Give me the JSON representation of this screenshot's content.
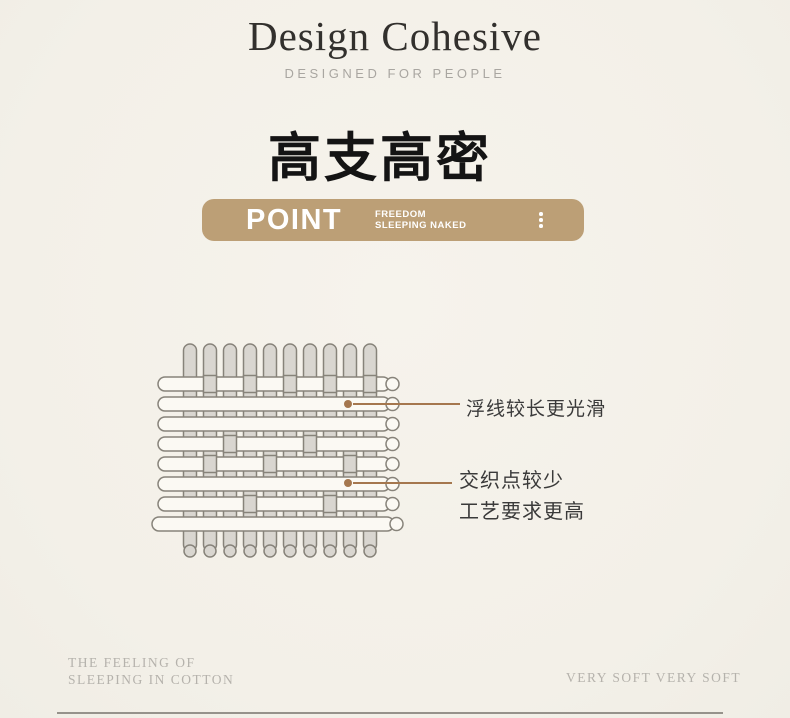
{
  "header": {
    "brand": "Design Cohesive",
    "tagline": "DESIGNED FOR PEOPLE"
  },
  "section_title": "高支高密",
  "banner": {
    "label": "POINT",
    "sub_line1": "FREEDOM",
    "sub_line2": "SLEEPING NAKED",
    "bg_color": "#bc9f76",
    "text_color": "#ffffff",
    "menu_icon": "vertical-ellipsis-icon"
  },
  "diagram": {
    "type": "weave-illustration",
    "description": "woven fabric diagram: vertical warp threads interlaced with long horizontal weft floats",
    "warp_count": 10,
    "weft_count": 8,
    "warp_fill": "#d9d6d0",
    "weft_fill": "#fbf9f3",
    "outline_color": "#87837a",
    "crossings": {
      "0": [
        1,
        3,
        5,
        7,
        9
      ],
      "3": [
        2,
        6
      ],
      "4": [
        1,
        4,
        8
      ],
      "6": [
        3,
        7
      ]
    },
    "annotation_color": "#a5774e",
    "annotations": [
      {
        "text": "浮线较长更光滑"
      },
      {
        "text_line1": "交织点较少",
        "text_line2": "工艺要求更高"
      }
    ]
  },
  "footer": {
    "left_line1": "THE FEELING OF",
    "left_line2": "SLEEPING IN COTTON",
    "right": "VERY SOFT VERY SOFT"
  }
}
